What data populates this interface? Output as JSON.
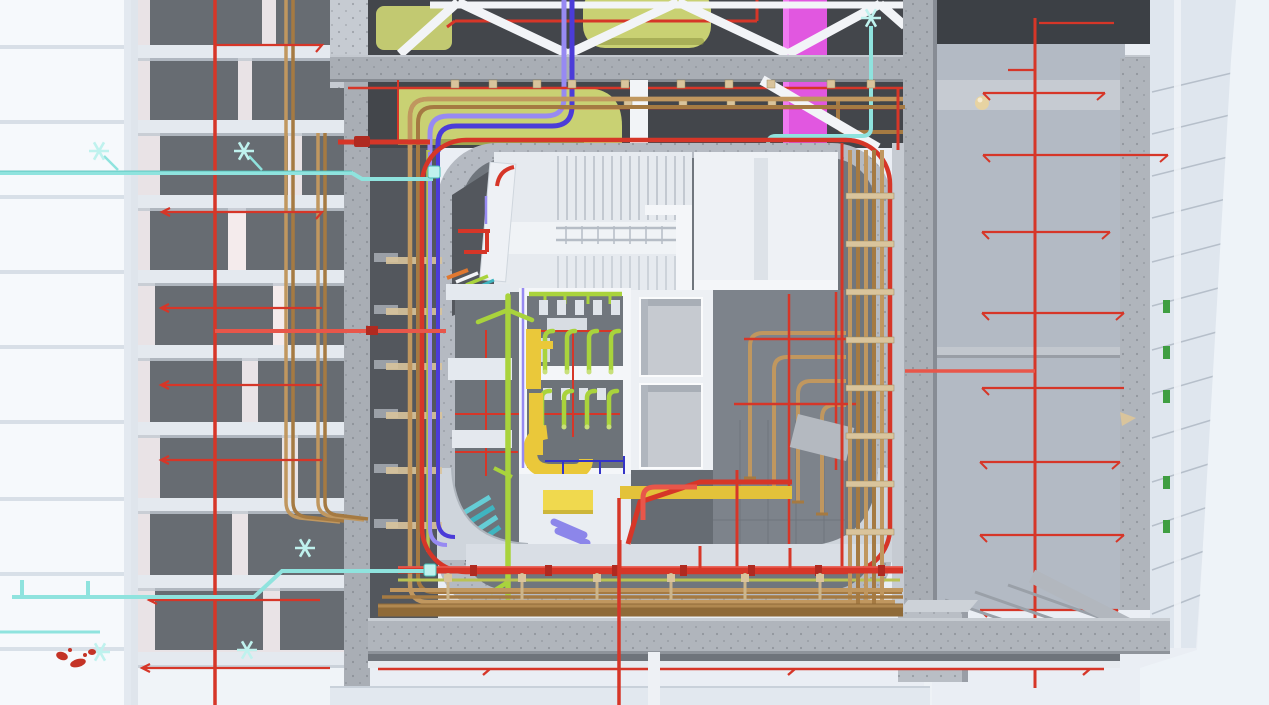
{
  "scene": {
    "view_type": "3d-bim-top-down-cutaway",
    "subject": "building-service-core-with-mep-systems",
    "regions": {
      "left": "glass-facade-and-structural-bay-with-risers",
      "top": "ceiling-plenum-with-steel-trusses-and-ducts",
      "center": "concrete-core-cutaway-stair-elevators-restrooms",
      "right": "concrete-frame-with-sprinkler-grid",
      "bottom": "floor-edge-beam-with-pipe-rack"
    },
    "systems": [
      {
        "name": "fire-protection-pipe",
        "color_key": "fire_red"
      },
      {
        "name": "hydronic-copper-pipe",
        "color_key": "copper"
      },
      {
        "name": "sanitary-green-pipe",
        "color_key": "sanitary_green"
      },
      {
        "name": "supply-duct-lime",
        "color_key": "duct_lime"
      },
      {
        "name": "exhaust-duct-yellow",
        "color_key": "duct_yellow"
      },
      {
        "name": "riser-duct-magenta",
        "color_key": "duct_magenta"
      },
      {
        "name": "chilled-water-purple-pipe",
        "color_key": "pipe_purple"
      },
      {
        "name": "condenser-blue-pipe",
        "color_key": "pipe_blue"
      },
      {
        "name": "drainage-cyan-pipe",
        "color_key": "cyan"
      },
      {
        "name": "electrical-conduit-blue",
        "color_key": "conduit_blue"
      }
    ]
  },
  "colors": {
    "sky": "#eaeef4",
    "sky_right": "#eef3f8",
    "facade_white": "#f6f9fc",
    "facade_line": "#ccd5df",
    "bay_bg": "#e9e3e6",
    "bay_glow": "#f6ecee",
    "panel_dark": "#676c72",
    "panel_darker": "#53575d",
    "beam_white": "#e4e9ef",
    "beam_shadow": "#c2c9d2",
    "concrete": "#a9aeb5",
    "concrete_light": "#c6cbd2",
    "concrete_dark": "#8d929a",
    "core_wall": "#b5bac2",
    "floor_dark": "#70767d",
    "floor_darker": "#5e636a",
    "room_white": "#ebeef2",
    "wall_white": "#f4f6f9",
    "steel_white": "#f2f4f7",
    "fire_red": "#d63628",
    "fire_red_bright": "#e8564a",
    "fire_red_dark": "#b02a20",
    "copper": "#c0975f",
    "copper_dark": "#a57a42",
    "copper_trunk": "#8f6a38",
    "copper_trunk_hi": "#b08850",
    "sanitary_green": "#a9d33c",
    "duct_lime": "#c9d173",
    "duct_lime_dark": "#8d9440",
    "duct_yellow": "#eac83a",
    "yellow_panel": "#f0d94e",
    "duct_magenta": "#e157e0",
    "magenta_hi": "#f07af0",
    "pipe_purple": "#978af2",
    "pipe_blue": "#4b3cd8",
    "conduit_blue": "#3434c8",
    "cyan": "#8fe3de",
    "cyan_dark": "#49bdb5",
    "cyan_bright": "#bff2ee",
    "teal": "#3fb5c0",
    "teal_light": "#65cdd6",
    "lavender": "#8c86ea",
    "hanger_tan": "#d9c49c",
    "hanger_tan_dark": "#9c8a60",
    "gold": "#e7d3a2",
    "green_tag": "#3f9e41",
    "splat_red": "#c43326",
    "deck": "#e2e8ef",
    "gap_dark": "#6f747b"
  }
}
